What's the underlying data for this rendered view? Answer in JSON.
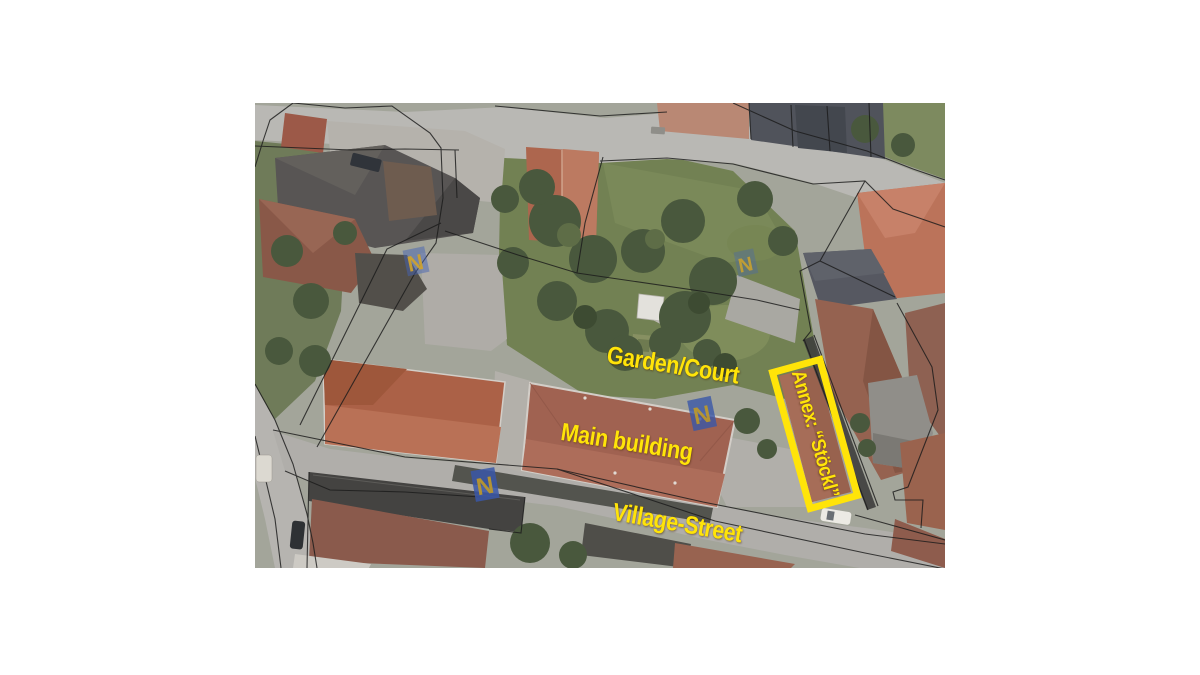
{
  "canvas": {
    "width": 1200,
    "height": 675,
    "background": "#FFFFFF"
  },
  "photo": {
    "type": "aerial-orthophoto",
    "left": 255,
    "top": 103,
    "width": 690,
    "height": 465,
    "description": "Aerial photo of a village block with black cadastral parcel boundary lines, red-roofed buildings, garden court, and streets"
  },
  "annotations": {
    "color": "#FFE409",
    "garden_court": "Garden/Court",
    "main_building": "Main building",
    "village_street": "Village-Street",
    "annex": "Annex: “Stöckl”"
  },
  "watermark": {
    "letter": "N"
  }
}
